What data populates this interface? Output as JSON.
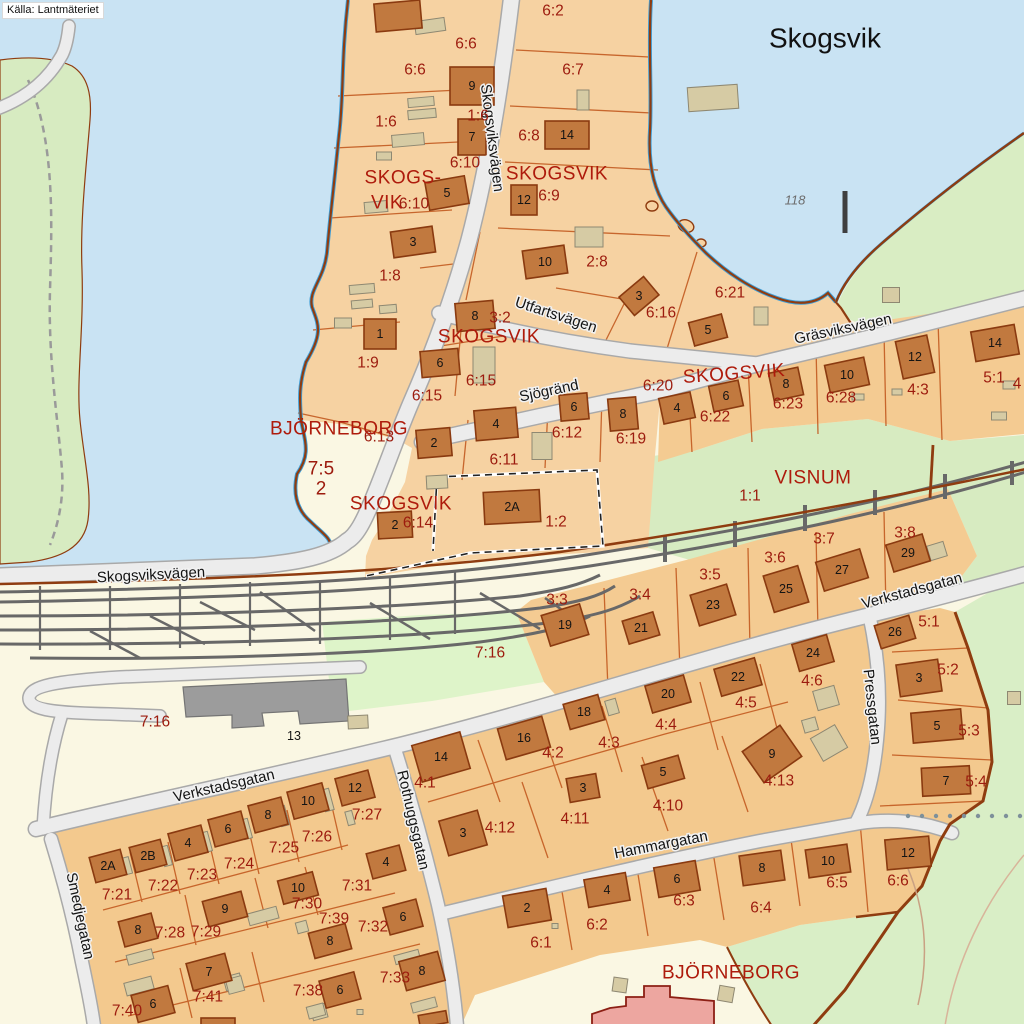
{
  "attribution": {
    "text": "Källa: Lantmäteriet"
  },
  "map": {
    "title_label": {
      "text": "Skogsvik",
      "x": 825,
      "y": 38
    },
    "depth_marker": {
      "text": "118",
      "x": 795,
      "y": 200
    },
    "place_labels": [
      {
        "text": "SKOGSVIK",
        "x": 557,
        "y": 174
      },
      {
        "text": "SKOGS-",
        "x": 403,
        "y": 178
      },
      {
        "text": "VIK",
        "x": 387,
        "y": 203
      },
      {
        "text": "SKOGSVIK",
        "x": 489,
        "y": 337
      },
      {
        "text": "SKOGSVIK",
        "x": 734,
        "y": 374,
        "rot": -4
      },
      {
        "text": "SKOGSVIK",
        "x": 401,
        "y": 504
      },
      {
        "text": "BJÖRNEBORG",
        "x": 339,
        "y": 429
      },
      {
        "text": "VISNUM",
        "x": 813,
        "y": 478
      },
      {
        "text": "BJÖRNEBORG",
        "x": 731,
        "y": 973
      }
    ],
    "street_labels": [
      {
        "text": "Skogsviksvägen",
        "x": 492,
        "y": 138,
        "rot": 83
      },
      {
        "text": "Utfartsvägen",
        "x": 556,
        "y": 315,
        "rot": 18
      },
      {
        "text": "Sjögränd",
        "x": 549,
        "y": 391,
        "rot": -12
      },
      {
        "text": "Gräsviksvägen",
        "x": 843,
        "y": 329,
        "rot": -12
      },
      {
        "text": "Skogsviksvägen",
        "x": 151,
        "y": 575,
        "rot": -3
      },
      {
        "text": "Verkstadsgatan",
        "x": 912,
        "y": 591,
        "rot": -15
      },
      {
        "text": "Verkstadsgatan",
        "x": 224,
        "y": 786,
        "rot": -13
      },
      {
        "text": "Pressgatan",
        "x": 872,
        "y": 707,
        "rot": 84
      },
      {
        "text": "Rothuggsgatan",
        "x": 413,
        "y": 820,
        "rot": 77
      },
      {
        "text": "Hammargatan",
        "x": 661,
        "y": 845,
        "rot": -11
      },
      {
        "text": "Smedjegatan",
        "x": 80,
        "y": 916,
        "rot": 78
      }
    ],
    "parcel_labels": [
      {
        "text": "6:2",
        "x": 553,
        "y": 11
      },
      {
        "text": "6:6",
        "x": 466,
        "y": 44
      },
      {
        "text": "6:6",
        "x": 415,
        "y": 70
      },
      {
        "text": "6:7",
        "x": 573,
        "y": 70
      },
      {
        "text": "1:6",
        "x": 386,
        "y": 122
      },
      {
        "text": "1:6",
        "x": 478,
        "y": 116
      },
      {
        "text": "6:8",
        "x": 529,
        "y": 136
      },
      {
        "text": "6:10",
        "x": 465,
        "y": 163
      },
      {
        "text": "6:10",
        "x": 414,
        "y": 204
      },
      {
        "text": "6:9",
        "x": 549,
        "y": 196
      },
      {
        "text": "2:8",
        "x": 597,
        "y": 262
      },
      {
        "text": "1:8",
        "x": 390,
        "y": 276
      },
      {
        "text": "6:16",
        "x": 661,
        "y": 313
      },
      {
        "text": "6:21",
        "x": 730,
        "y": 293
      },
      {
        "text": "1:9",
        "x": 368,
        "y": 363
      },
      {
        "text": "3:2",
        "x": 500,
        "y": 318
      },
      {
        "text": "6:15",
        "x": 481,
        "y": 381
      },
      {
        "text": "6:15",
        "x": 427,
        "y": 396
      },
      {
        "text": "6:20",
        "x": 658,
        "y": 386
      },
      {
        "text": "6:22",
        "x": 715,
        "y": 417
      },
      {
        "text": "6:23",
        "x": 788,
        "y": 404
      },
      {
        "text": "6:28",
        "x": 841,
        "y": 398
      },
      {
        "text": "4:3",
        "x": 918,
        "y": 390
      },
      {
        "text": "5:1",
        "x": 994,
        "y": 378
      },
      {
        "text": "6:13",
        "x": 379,
        "y": 437
      },
      {
        "text": "6:11",
        "x": 504,
        "y": 460
      },
      {
        "text": "6:12",
        "x": 567,
        "y": 433
      },
      {
        "text": "6:19",
        "x": 631,
        "y": 439
      },
      {
        "text": "7:5",
        "x": 321,
        "y": 469,
        "size": 19
      },
      {
        "text": "2",
        "x": 321,
        "y": 489,
        "size": 19
      },
      {
        "text": "6:14",
        "x": 418,
        "y": 523
      },
      {
        "text": "1:2",
        "x": 556,
        "y": 522
      },
      {
        "text": "1:1",
        "x": 750,
        "y": 496
      },
      {
        "text": "3:8",
        "x": 905,
        "y": 533
      },
      {
        "text": "3:7",
        "x": 824,
        "y": 539
      },
      {
        "text": "3:6",
        "x": 775,
        "y": 558
      },
      {
        "text": "3:5",
        "x": 710,
        "y": 575
      },
      {
        "text": "3:4",
        "x": 640,
        "y": 595
      },
      {
        "text": "3:3",
        "x": 557,
        "y": 600
      },
      {
        "text": "7:16",
        "x": 490,
        "y": 653
      },
      {
        "text": "7:16",
        "x": 155,
        "y": 722
      },
      {
        "text": "5:1",
        "x": 929,
        "y": 622
      },
      {
        "text": "5:2",
        "x": 948,
        "y": 670
      },
      {
        "text": "5:3",
        "x": 969,
        "y": 731
      },
      {
        "text": "5:4",
        "x": 976,
        "y": 782
      },
      {
        "text": "4:6",
        "x": 812,
        "y": 681
      },
      {
        "text": "4:5",
        "x": 746,
        "y": 703
      },
      {
        "text": "4:4",
        "x": 666,
        "y": 725
      },
      {
        "text": "4:3",
        "x": 609,
        "y": 743
      },
      {
        "text": "4:2",
        "x": 553,
        "y": 753
      },
      {
        "text": "4:1",
        "x": 425,
        "y": 783
      },
      {
        "text": "4:13",
        "x": 779,
        "y": 781
      },
      {
        "text": "4:12",
        "x": 500,
        "y": 828
      },
      {
        "text": "4:11",
        "x": 575,
        "y": 819
      },
      {
        "text": "4:10",
        "x": 668,
        "y": 806
      },
      {
        "text": "7:21",
        "x": 117,
        "y": 895
      },
      {
        "text": "7:22",
        "x": 163,
        "y": 886
      },
      {
        "text": "7:23",
        "x": 202,
        "y": 875
      },
      {
        "text": "7:24",
        "x": 239,
        "y": 864
      },
      {
        "text": "7:25",
        "x": 284,
        "y": 848
      },
      {
        "text": "7:26",
        "x": 317,
        "y": 837
      },
      {
        "text": "7:27",
        "x": 367,
        "y": 815
      },
      {
        "text": "7:28",
        "x": 170,
        "y": 933
      },
      {
        "text": "7:29",
        "x": 206,
        "y": 932
      },
      {
        "text": "7:30",
        "x": 307,
        "y": 904
      },
      {
        "text": "7:39",
        "x": 334,
        "y": 919
      },
      {
        "text": "7:31",
        "x": 357,
        "y": 886
      },
      {
        "text": "7:32",
        "x": 373,
        "y": 927
      },
      {
        "text": "7:33",
        "x": 395,
        "y": 978
      },
      {
        "text": "7:38",
        "x": 308,
        "y": 991
      },
      {
        "text": "7:40",
        "x": 127,
        "y": 1011
      },
      {
        "text": "7:41",
        "x": 208,
        "y": 997
      },
      {
        "text": "6:1",
        "x": 541,
        "y": 943
      },
      {
        "text": "6:2",
        "x": 597,
        "y": 925
      },
      {
        "text": "6:3",
        "x": 684,
        "y": 901
      },
      {
        "text": "6:4",
        "x": 761,
        "y": 908
      },
      {
        "text": "6:5",
        "x": 837,
        "y": 883
      },
      {
        "text": "6:6",
        "x": 898,
        "y": 881
      },
      {
        "text": "4",
        "x": 1017,
        "y": 384
      }
    ],
    "buildings": [
      {
        "n": "9",
        "x": 472,
        "y": 86,
        "w": 44,
        "h": 38,
        "r": 0
      },
      {
        "n": "14",
        "x": 567,
        "y": 135,
        "w": 44,
        "h": 28,
        "r": 0
      },
      {
        "n": "7",
        "x": 472,
        "y": 137,
        "w": 28,
        "h": 36,
        "r": 0
      },
      {
        "n": "5",
        "x": 447,
        "y": 193,
        "w": 40,
        "h": 28,
        "r": -10
      },
      {
        "n": "12",
        "x": 524,
        "y": 200,
        "w": 26,
        "h": 30,
        "r": 0
      },
      {
        "n": "3",
        "x": 413,
        "y": 242,
        "w": 42,
        "h": 26,
        "r": -8
      },
      {
        "n": "10",
        "x": 545,
        "y": 262,
        "w": 42,
        "h": 28,
        "r": -8
      },
      {
        "n": "3",
        "x": 639,
        "y": 296,
        "w": 32,
        "h": 24,
        "r": -40
      },
      {
        "n": "5",
        "x": 708,
        "y": 330,
        "w": 34,
        "h": 24,
        "r": -15
      },
      {
        "n": "1",
        "x": 380,
        "y": 334,
        "w": 32,
        "h": 30,
        "r": 0
      },
      {
        "n": "8",
        "x": 475,
        "y": 316,
        "w": 38,
        "h": 28,
        "r": -5
      },
      {
        "n": "6",
        "x": 440,
        "y": 363,
        "w": 38,
        "h": 26,
        "r": -5
      },
      {
        "n": "",
        "x": 398,
        "y": 16,
        "w": 46,
        "h": 28,
        "r": -5
      },
      {
        "n": "2",
        "x": 434,
        "y": 443,
        "w": 34,
        "h": 28,
        "r": -5
      },
      {
        "n": "4",
        "x": 496,
        "y": 424,
        "w": 42,
        "h": 30,
        "r": -5
      },
      {
        "n": "6",
        "x": 574,
        "y": 407,
        "w": 28,
        "h": 26,
        "r": -5
      },
      {
        "n": "8",
        "x": 623,
        "y": 414,
        "w": 28,
        "h": 32,
        "r": -5
      },
      {
        "n": "4",
        "x": 677,
        "y": 408,
        "w": 32,
        "h": 26,
        "r": -12
      },
      {
        "n": "6",
        "x": 726,
        "y": 396,
        "w": 30,
        "h": 26,
        "r": -12
      },
      {
        "n": "8",
        "x": 786,
        "y": 384,
        "w": 30,
        "h": 28,
        "r": -12
      },
      {
        "n": "10",
        "x": 847,
        "y": 375,
        "w": 40,
        "h": 28,
        "r": -12
      },
      {
        "n": "12",
        "x": 915,
        "y": 357,
        "w": 32,
        "h": 38,
        "r": -12
      },
      {
        "n": "14",
        "x": 995,
        "y": 343,
        "w": 44,
        "h": 30,
        "r": -10
      },
      {
        "n": "2",
        "x": 395,
        "y": 525,
        "w": 34,
        "h": 26,
        "r": -3
      },
      {
        "n": "2A",
        "x": 512,
        "y": 507,
        "w": 56,
        "h": 32,
        "r": -3
      },
      {
        "n": "29",
        "x": 908,
        "y": 553,
        "w": 38,
        "h": 28,
        "r": -17
      },
      {
        "n": "27",
        "x": 842,
        "y": 570,
        "w": 46,
        "h": 30,
        "r": -17
      },
      {
        "n": "25",
        "x": 786,
        "y": 589,
        "w": 36,
        "h": 38,
        "r": -17
      },
      {
        "n": "23",
        "x": 713,
        "y": 605,
        "w": 38,
        "h": 32,
        "r": -17
      },
      {
        "n": "21",
        "x": 641,
        "y": 628,
        "w": 32,
        "h": 24,
        "r": -17
      },
      {
        "n": "19",
        "x": 565,
        "y": 625,
        "w": 40,
        "h": 32,
        "r": -17
      },
      {
        "n": "26",
        "x": 895,
        "y": 632,
        "w": 36,
        "h": 24,
        "r": -17
      },
      {
        "n": "3",
        "x": 919,
        "y": 678,
        "w": 42,
        "h": 32,
        "r": -8
      },
      {
        "n": "5",
        "x": 937,
        "y": 726,
        "w": 50,
        "h": 30,
        "r": -5
      },
      {
        "n": "7",
        "x": 946,
        "y": 781,
        "w": 48,
        "h": 28,
        "r": -3
      },
      {
        "n": "24",
        "x": 813,
        "y": 653,
        "w": 36,
        "h": 28,
        "r": -16
      },
      {
        "n": "22",
        "x": 738,
        "y": 677,
        "w": 42,
        "h": 28,
        "r": -16
      },
      {
        "n": "20",
        "x": 668,
        "y": 694,
        "w": 40,
        "h": 28,
        "r": -16
      },
      {
        "n": "18",
        "x": 584,
        "y": 712,
        "w": 36,
        "h": 26,
        "r": -16
      },
      {
        "n": "16",
        "x": 524,
        "y": 738,
        "w": 46,
        "h": 32,
        "r": -16
      },
      {
        "n": "14",
        "x": 441,
        "y": 757,
        "w": 50,
        "h": 38,
        "r": -16
      },
      {
        "n": "9",
        "x": 772,
        "y": 754,
        "w": 46,
        "h": 38,
        "r": -35
      },
      {
        "n": "5",
        "x": 663,
        "y": 772,
        "w": 38,
        "h": 24,
        "r": -16
      },
      {
        "n": "3",
        "x": 583,
        "y": 788,
        "w": 30,
        "h": 24,
        "r": -10
      },
      {
        "n": "3",
        "x": 463,
        "y": 833,
        "w": 40,
        "h": 36,
        "r": -16
      },
      {
        "n": "2",
        "x": 527,
        "y": 908,
        "w": 44,
        "h": 32,
        "r": -10
      },
      {
        "n": "4",
        "x": 607,
        "y": 890,
        "w": 42,
        "h": 28,
        "r": -10
      },
      {
        "n": "6",
        "x": 677,
        "y": 879,
        "w": 42,
        "h": 30,
        "r": -10
      },
      {
        "n": "8",
        "x": 762,
        "y": 868,
        "w": 42,
        "h": 30,
        "r": -8
      },
      {
        "n": "10",
        "x": 828,
        "y": 861,
        "w": 42,
        "h": 28,
        "r": -8
      },
      {
        "n": "12",
        "x": 908,
        "y": 853,
        "w": 44,
        "h": 30,
        "r": -5
      },
      {
        "n": "2A",
        "x": 108,
        "y": 866,
        "w": 32,
        "h": 26,
        "r": -15
      },
      {
        "n": "2B",
        "x": 148,
        "y": 856,
        "w": 32,
        "h": 26,
        "r": -15
      },
      {
        "n": "4",
        "x": 188,
        "y": 843,
        "w": 34,
        "h": 28,
        "r": -15
      },
      {
        "n": "6",
        "x": 228,
        "y": 829,
        "w": 34,
        "h": 28,
        "r": -15
      },
      {
        "n": "8",
        "x": 268,
        "y": 815,
        "w": 34,
        "h": 28,
        "r": -15
      },
      {
        "n": "10",
        "x": 308,
        "y": 801,
        "w": 36,
        "h": 28,
        "r": -15
      },
      {
        "n": "12",
        "x": 355,
        "y": 788,
        "w": 34,
        "h": 28,
        "r": -15
      },
      {
        "n": "8",
        "x": 138,
        "y": 930,
        "w": 34,
        "h": 26,
        "r": -15
      },
      {
        "n": "9",
        "x": 225,
        "y": 909,
        "w": 40,
        "h": 26,
        "r": -15
      },
      {
        "n": "10",
        "x": 298,
        "y": 888,
        "w": 36,
        "h": 24,
        "r": -15
      },
      {
        "n": "4",
        "x": 386,
        "y": 862,
        "w": 34,
        "h": 26,
        "r": -15
      },
      {
        "n": "8",
        "x": 330,
        "y": 941,
        "w": 38,
        "h": 26,
        "r": -15
      },
      {
        "n": "6",
        "x": 403,
        "y": 917,
        "w": 34,
        "h": 28,
        "r": -15
      },
      {
        "n": "7",
        "x": 209,
        "y": 972,
        "w": 40,
        "h": 28,
        "r": -15
      },
      {
        "n": "6",
        "x": 153,
        "y": 1004,
        "w": 38,
        "h": 28,
        "r": -15
      },
      {
        "n": "6",
        "x": 340,
        "y": 990,
        "w": 36,
        "h": 28,
        "r": -15
      },
      {
        "n": "8",
        "x": 422,
        "y": 971,
        "w": 40,
        "h": 30,
        "r": -15
      },
      {
        "n": "13",
        "x": 294,
        "y": 736,
        "w": 0,
        "h": 0,
        "r": 0
      },
      {
        "n": "",
        "x": 433,
        "y": 1019,
        "w": 28,
        "h": 12,
        "r": -10
      },
      {
        "n": "",
        "x": 218,
        "y": 1022,
        "w": 34,
        "h": 8,
        "r": 0
      }
    ],
    "colors": {
      "water": "#c9e3f3",
      "land": "#f6d2a2",
      "land2": "#f3c990",
      "green": "#d7ebc1",
      "green_bright": "#def4c9",
      "cream": "#faf7e3",
      "building": "#c1793f",
      "building_stroke": "#8a3a10",
      "shed": "#d6cba4",
      "road_fill": "#ececec",
      "road_casing": "#a9a9a9",
      "rail": "#686868",
      "parcel_line": "#c25a20",
      "boundary": "#8f3c10",
      "parcel_text": "#9c1b0e",
      "place_text": "#ae1b0c",
      "shore_blue": "#3f9fd8",
      "pink_building": "#eda6a0",
      "gray_building": "#9c9c9c"
    }
  }
}
